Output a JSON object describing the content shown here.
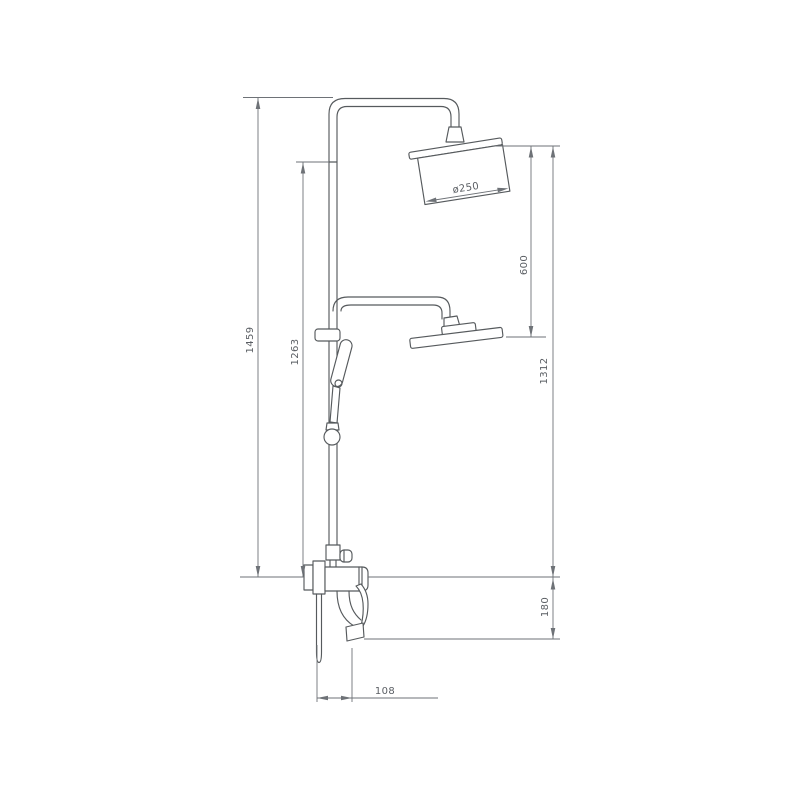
{
  "figure": {
    "kind": "shower-column-technical-drawing",
    "dimensions": {
      "total_height": "1459",
      "column_height": "1263",
      "overhead_drop": "600",
      "overhead_to_outlet": "1312",
      "outlet_offset": "180",
      "spout_reach": "108",
      "head_diameter": "ø250"
    }
  },
  "colors": {
    "background": "#ffffff",
    "line": "#565a5d",
    "dimension": "#6e7277",
    "text": "#5a5e63"
  }
}
